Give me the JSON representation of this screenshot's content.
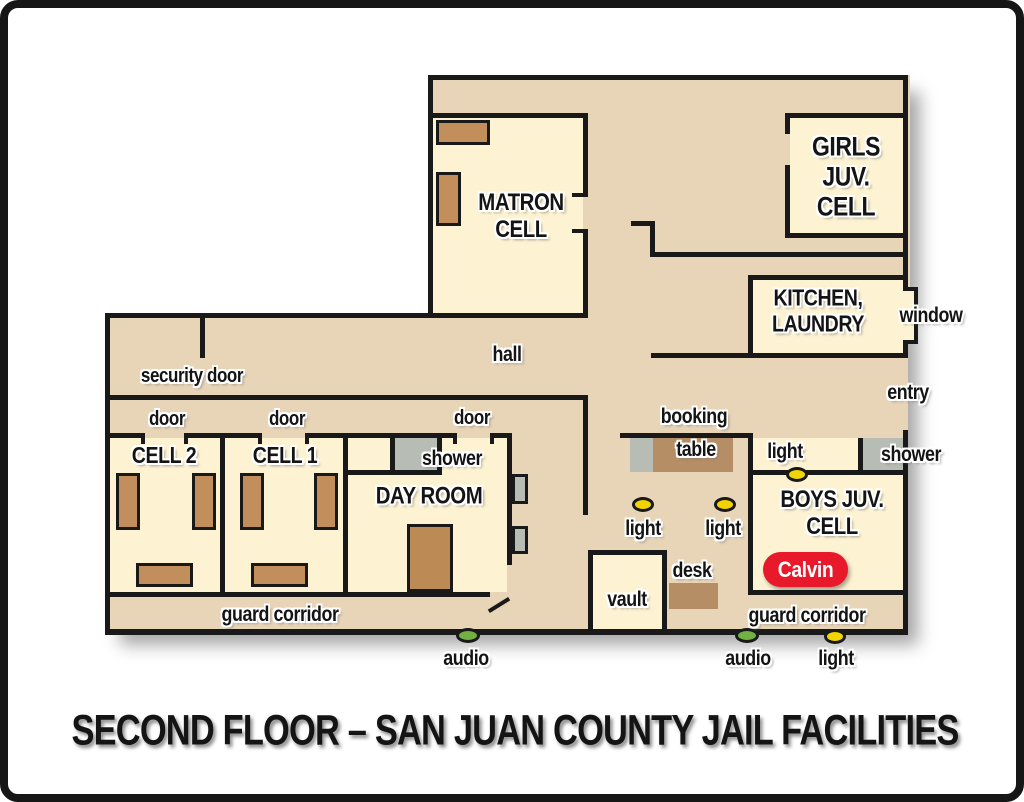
{
  "title": "SECOND FLOOR – SAN JUAN COUNTY JAIL FACILITIES",
  "rooms": {
    "matron_cell": "MATRON\nCELL",
    "girls_juv_cell": "GIRLS\nJUV.\nCELL",
    "kitchen_laundry": "KITCHEN,\nLAUNDRY",
    "cell2": "CELL 2",
    "cell1": "CELL 1",
    "day_room": "DAY ROOM",
    "boys_juv_cell": "BOYS JUV.\nCELL",
    "vault": "vault"
  },
  "labels": {
    "hall": "hall",
    "security_door": "security door",
    "door": "door",
    "shower": "shower",
    "window": "window",
    "entry": "entry",
    "booking": "booking",
    "table": "table",
    "light": "light",
    "audio": "audio",
    "desk": "desk",
    "guard_corridor": "guard corridor"
  },
  "occupant": {
    "name": "Calvin",
    "badge_color": "#e8192b"
  },
  "markers": {
    "light_color": "#f3d403",
    "audio_color": "#72b042"
  },
  "palette": {
    "corridor_tan": "#e8d5b8",
    "room_cream": "#fdf3d2",
    "wall_black": "#191919",
    "bed_brown": "#c28e5c",
    "furniture_brown": "#b58e66",
    "fixture_gray": "#b7bcb4"
  }
}
